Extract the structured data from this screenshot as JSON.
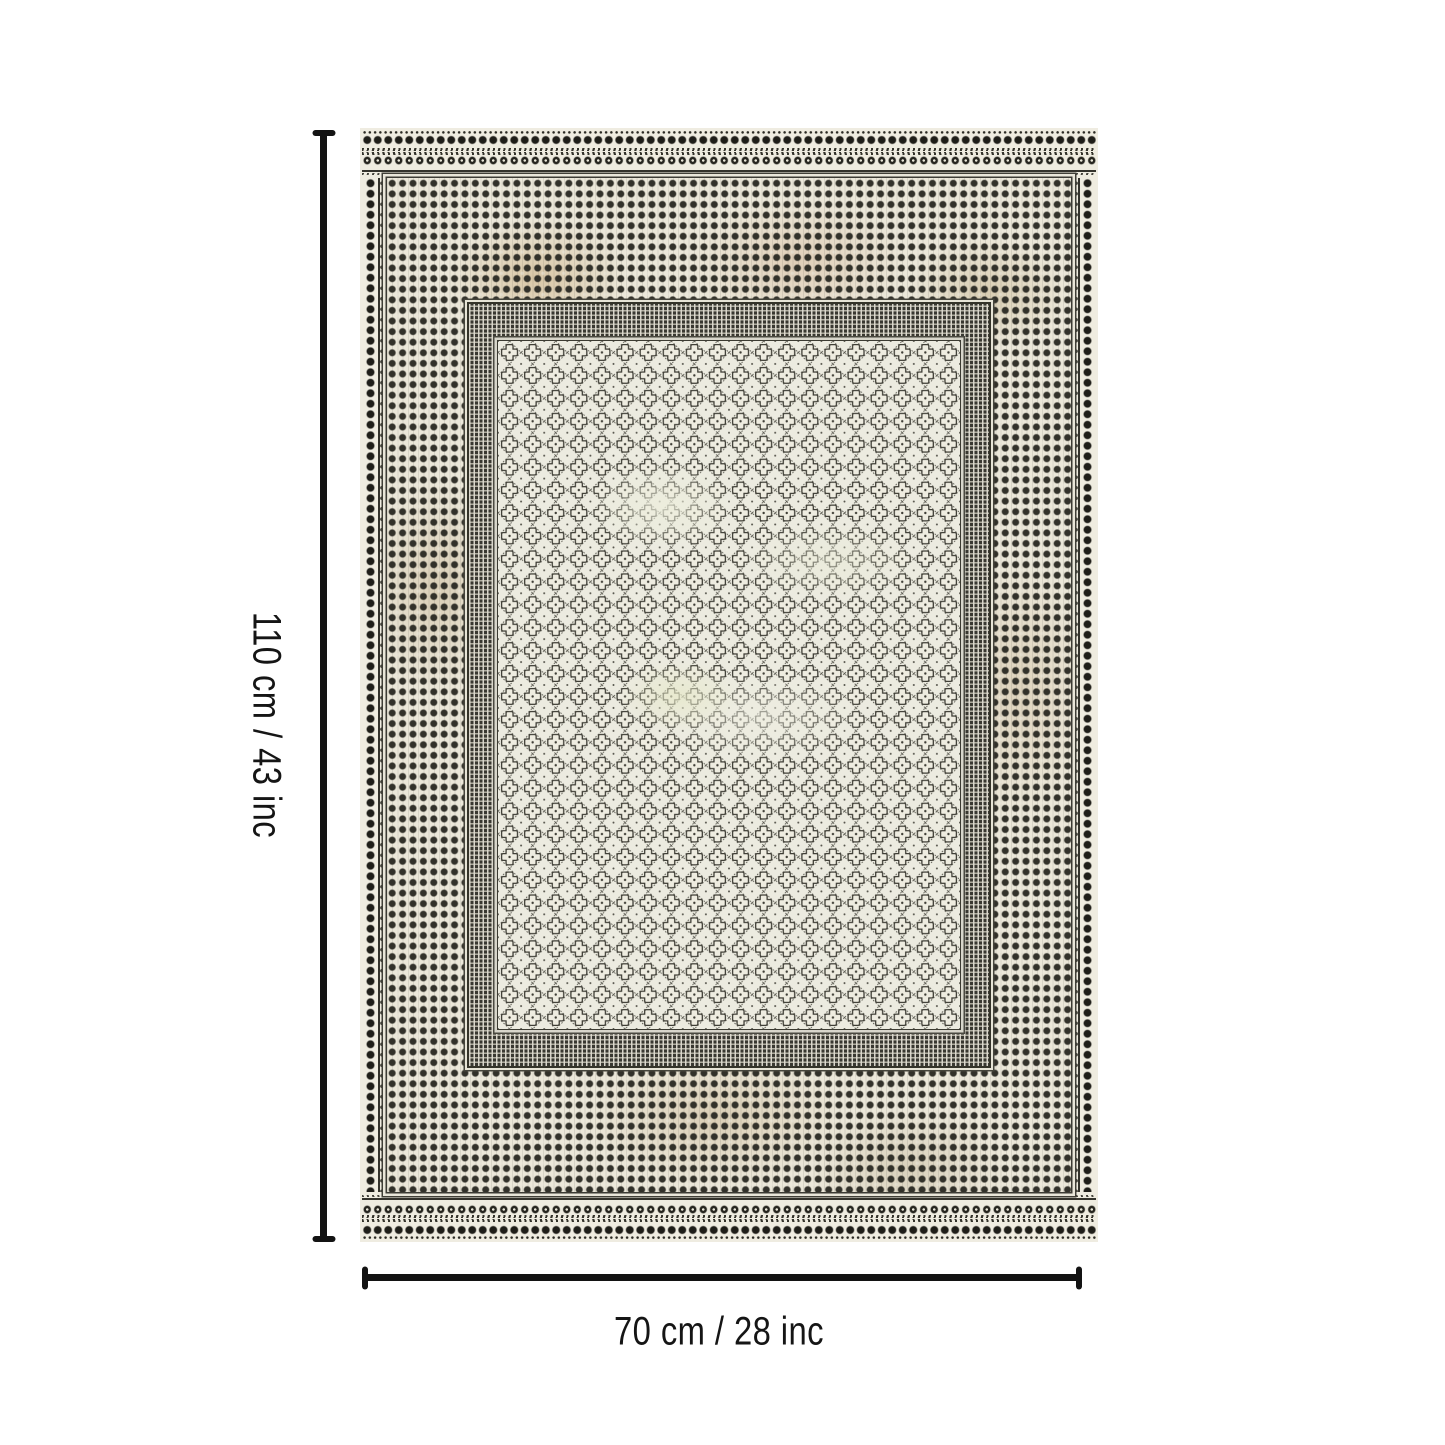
{
  "figure": {
    "height_label": "110 cm / 43 inc",
    "width_label": "70 cm / 28 inc"
  },
  "rug": {
    "description": "rectangular rug, cream ground with dark dotted border bands and central quatrefoil trellis field",
    "colors": {
      "base": "#efece1",
      "ink": "#2b2a25",
      "wear_beige": "#d9c6a9",
      "annotation": "#131313",
      "page_background": "#ffffff"
    }
  }
}
